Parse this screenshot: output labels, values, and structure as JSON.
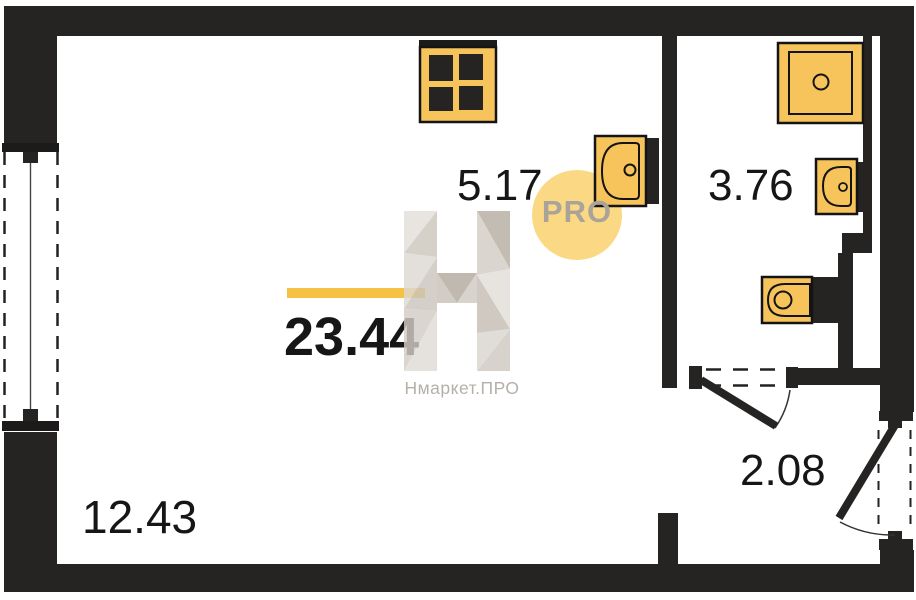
{
  "plan": {
    "rooms": {
      "total": {
        "area": "23.44"
      },
      "kitchen_zone": {
        "area": "5.17"
      },
      "living_zone": {
        "area": "12.43"
      },
      "bathroom": {
        "area": "3.76"
      },
      "hallway": {
        "area": "2.08"
      }
    },
    "fixtures": [
      "stove",
      "kitchen-sink",
      "shower",
      "bathroom-sink",
      "toilet"
    ],
    "features": [
      "window",
      "entry-door",
      "bathroom-door"
    ]
  },
  "watermark": {
    "badge": "PRO",
    "brand": "Нмаркет.ПРО"
  },
  "colors": {
    "wall": "#262423",
    "fixture": "#F7C45C",
    "accent_bar": "#F5C244",
    "badge_circle": "#FAC954",
    "label": "#161616",
    "watermark_text": "#B5B0A9"
  }
}
